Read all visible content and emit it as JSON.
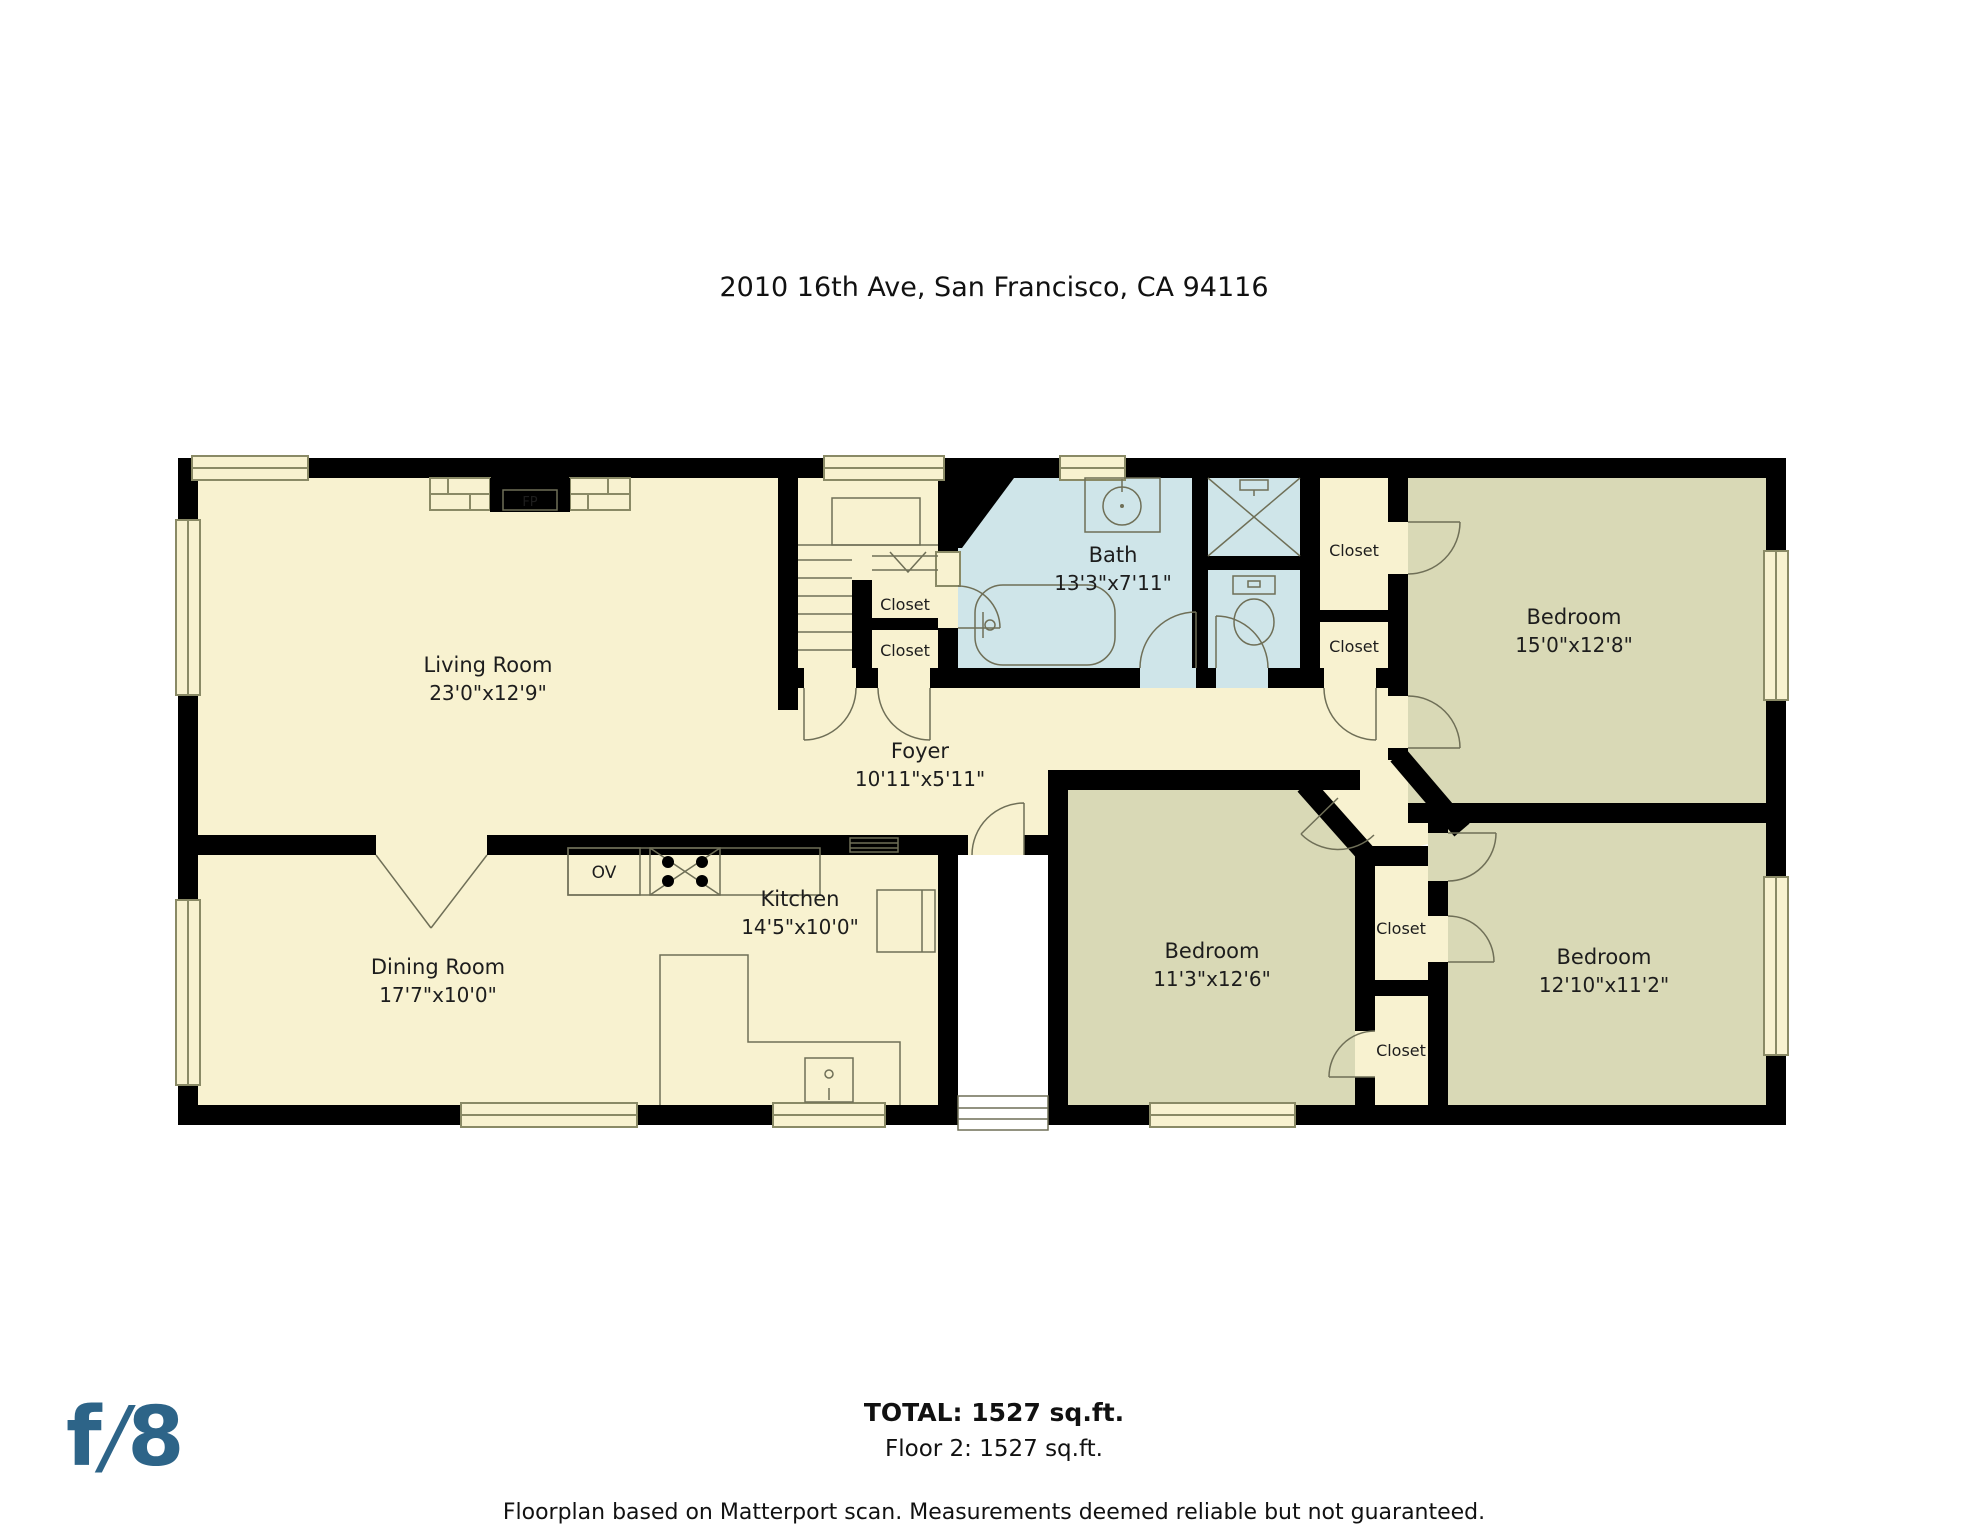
{
  "title": "2010 16th Ave, San Francisco, CA 94116",
  "rooms": {
    "living": {
      "name": "Living Room",
      "dims": "23'0\"x12'9\""
    },
    "dining": {
      "name": "Dining Room",
      "dims": "17'7\"x10'0\""
    },
    "kitchen": {
      "name": "Kitchen",
      "dims": "14'5\"x10'0\""
    },
    "foyer": {
      "name": "Foyer",
      "dims": "10'11\"x5'11\""
    },
    "bath": {
      "name": "Bath",
      "dims": "13'3\"x7'11\""
    },
    "bedroom_right": {
      "name": "Bedroom",
      "dims": "15'0\"x12'8\""
    },
    "bedroom_middle": {
      "name": "Bedroom",
      "dims": "11'3\"x12'6\""
    },
    "bedroom_bottom": {
      "name": "Bedroom",
      "dims": "12'10\"x11'2\""
    }
  },
  "closets": [
    "Closet",
    "Closet",
    "Closet",
    "Closet",
    "Closet",
    "Closet"
  ],
  "fixtures": {
    "fireplace": "FP",
    "oven": "OV"
  },
  "footer": {
    "total": "TOTAL: 1527 sq.ft.",
    "floor": "Floor 2: 1527 sq.ft.",
    "disclaimer": "Floorplan based on Matterport scan. Measurements deemed reliable but not guaranteed."
  },
  "logo": {
    "f": "f",
    "slash": "/",
    "eight": "8",
    "color": "#2d6488"
  },
  "colors": {
    "room": "#f8f2d0",
    "bedroom": "#d9d9b6",
    "bath": "#cfe5e9",
    "wall": "#000000"
  }
}
